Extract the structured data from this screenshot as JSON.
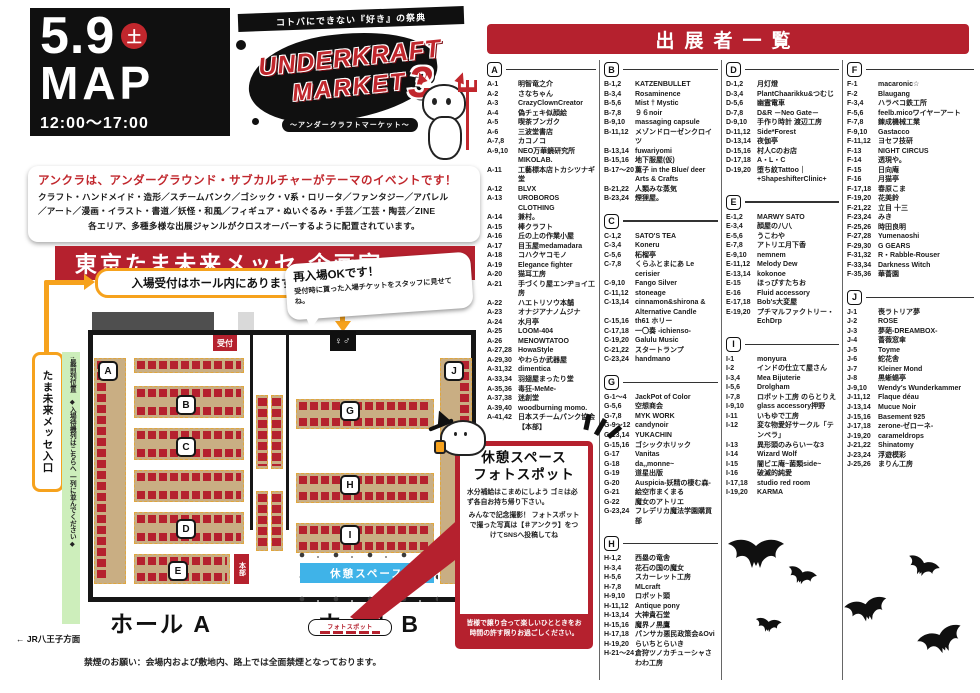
{
  "event": {
    "date_big": "5.9",
    "day_badge": "土",
    "map_label": "MAP",
    "time": "12:00〜17:00",
    "ribbon": "コトバにできない『好き』の祭典",
    "logo_line1": "UNDERKRAFT",
    "logo_line2": "MARKET",
    "logo_number": "3",
    "logo_sub": "〜アンダークラフトマーケット〜"
  },
  "intro": {
    "headline": "アンクラは、アンダーグラウンド・サブカルチャーがテーマのイベントです！",
    "line1": "クラフト・ハンドメイド・造形／スチームパンク／ゴシック・V系・ロリータ／ファンタジー／アパレル",
    "line2": "／アート／漫画・イラスト・書道／妖怪・和風／フィギュア・ぬいぐるみ・手芸／工芸・陶芸／ZINE",
    "line3": "各エリア、多種多様な出展ジャンルがクロスオーバーするように配置されています。"
  },
  "venue_heading": "東京たま未来メッセ 企画室 A・B",
  "map": {
    "reception_callout": "入場受付はホール内にあります",
    "reentry_title": "再入場OKです！",
    "reentry_body": "受付時に貰った入場チケットをスタッフに見せてね。",
    "reception_label": "受付",
    "entrance_label": "出入口",
    "toilet_label": "♀♂",
    "hq_label": "本部",
    "rest_space_label": "休憩スペース",
    "photo_spot_label": "フォトスポット",
    "hall_a_label": "ホール A",
    "hall_b_label": "ホール B",
    "entrance_box": "たま未来メッセ入口",
    "front_row": "↑最前列位置",
    "queue_note": "◆入場待機列はこちらへ 一列に並んでください◆",
    "jr_note": "← JR八王子方面",
    "no_smoking": "禁煙のお願い：会場内および敷地内、路上では全面禁煙となっております。",
    "badges": [
      {
        "letter": "A",
        "x": 98,
        "y": 106
      },
      {
        "letter": "B",
        "x": 176,
        "y": 140
      },
      {
        "letter": "C",
        "x": 176,
        "y": 182
      },
      {
        "letter": "D",
        "x": 176,
        "y": 264
      },
      {
        "letter": "E",
        "x": 168,
        "y": 306
      },
      {
        "letter": "G",
        "x": 340,
        "y": 146
      },
      {
        "letter": "H",
        "x": 340,
        "y": 220
      },
      {
        "letter": "I",
        "x": 340,
        "y": 270
      },
      {
        "letter": "J",
        "x": 444,
        "y": 106
      }
    ]
  },
  "info_box": {
    "title1": "休憩スペース",
    "title2": "フォトスポット",
    "body1": "水分補給はこまめにしよう ゴミは必ず各自お持ち帰り下さい。",
    "body2": "みんなで記念撮影！ フォトスポットで撮った写真は【＃アンクラ】をつけてSNSへ投稿してね",
    "footer": "皆様で譲り合って楽しいひとときをお時間の許す限りお過ごしください。"
  },
  "exhibitors": {
    "title": "出展者一覧",
    "sections": [
      {
        "letter": "A",
        "column": 0,
        "entries": [
          {
            "code": "A-1",
            "name": "明智竜之介"
          },
          {
            "code": "A-2",
            "name": "さなちゃん"
          },
          {
            "code": "A-3",
            "name": "CrazyClownCreator"
          },
          {
            "code": "A-4",
            "name": "偽チェキ似顔絵"
          },
          {
            "code": "A-5",
            "name": "喫茶ブンガク"
          },
          {
            "code": "A-6",
            "name": "三波堂書店"
          },
          {
            "code": "A-7,8",
            "name": "カコノコ"
          },
          {
            "code": "A-9,10",
            "name": "NEO万華鏡研究所MIKOLAB."
          },
          {
            "code": "A-11",
            "name": "工藝標本店トカシツナギ堂"
          },
          {
            "code": "A-12",
            "name": "BLVX"
          },
          {
            "code": "A-13",
            "name": "UROBOROS CLOTHING"
          },
          {
            "code": "A-14",
            "name": "兼村。"
          },
          {
            "code": "A-15",
            "name": "棒クラフト"
          },
          {
            "code": "A-16",
            "name": "丘の上の作業小屋"
          },
          {
            "code": "A-17",
            "name": "目玉屋medamadara"
          },
          {
            "code": "A-18",
            "name": "コハクヤコモノ"
          },
          {
            "code": "A-19",
            "name": "Elegance fighter"
          },
          {
            "code": "A-20",
            "name": "猫耳工房"
          },
          {
            "code": "A-21",
            "name": "手づくり屋エンヂョイ工房"
          },
          {
            "code": "A-22",
            "name": "ハエトリソウ本舗"
          },
          {
            "code": "A-23",
            "name": "オナジアナノムジナ"
          },
          {
            "code": "A-24",
            "name": "水月亭"
          },
          {
            "code": "A-25",
            "name": "LOOM-404"
          },
          {
            "code": "A-26",
            "name": "MENOWTATOO"
          },
          {
            "code": "A-27,28",
            "name": "HowaStyle"
          },
          {
            "code": "A-29,30",
            "name": "やわらか武器屋"
          },
          {
            "code": "A-31,32",
            "name": "dimentica"
          },
          {
            "code": "A-33,34",
            "name": "羽翅屋まったり堂"
          },
          {
            "code": "A-35,36",
            "name": "毒狂-MeMe-"
          },
          {
            "code": "A-37,38",
            "name": "迷創堂"
          },
          {
            "code": "A-39,40",
            "name": "woodburning momo."
          },
          {
            "code": "A-41,42",
            "name": "日本スチームパンク協会【本部】"
          }
        ]
      },
      {
        "letter": "B",
        "column": 1,
        "entries": [
          {
            "code": "B-1,2",
            "name": "KATZENBULLET"
          },
          {
            "code": "B-3,4",
            "name": "Rosaminence"
          },
          {
            "code": "B-5,6",
            "name": "Mist † Mystic"
          },
          {
            "code": "B-7,8",
            "name": "９６noir"
          },
          {
            "code": "B-9,10",
            "name": "massaging capsule"
          },
          {
            "code": "B-11,12",
            "name": "メゾンドローゼンクロイツ"
          },
          {
            "code": "B-13,14",
            "name": "fuwariyomi"
          },
          {
            "code": "B-15,16",
            "name": "地下服屋(仮)"
          },
          {
            "code": "B-17〜20",
            "name": "薫子 in the Blue/ deer Arts & Crafts"
          },
          {
            "code": "B-21,22",
            "name": "人類みな蒸気"
          },
          {
            "code": "B-23,24",
            "name": "煙狸屋。"
          }
        ]
      },
      {
        "letter": "C",
        "column": 1,
        "entries": [
          {
            "code": "C-1,2",
            "name": "SATO'S TEA"
          },
          {
            "code": "C-3,4",
            "name": "Koneru"
          },
          {
            "code": "C-5,6",
            "name": "柘榴亭"
          },
          {
            "code": "C-7,8",
            "name": "くらふとまにあ Le cerisier"
          },
          {
            "code": "C-9,10",
            "name": "Fango Silver"
          },
          {
            "code": "C-11,12",
            "name": "stoneage"
          },
          {
            "code": "C-13,14",
            "name": "cinnamon&shirona & Alternative Candle"
          },
          {
            "code": "C-15,16",
            "name": "th61 ホリー"
          },
          {
            "code": "C-17,18",
            "name": "一〇奏 -ichienso-"
          },
          {
            "code": "C-19,20",
            "name": "Galulu Music"
          },
          {
            "code": "C-21,22",
            "name": "スタートランプ"
          },
          {
            "code": "C-23,24",
            "name": "handmano"
          }
        ]
      },
      {
        "letter": "G",
        "column": 1,
        "entries": [
          {
            "code": "G-1〜4",
            "name": "JackPot of Color"
          },
          {
            "code": "G-5,6",
            "name": "空想商会"
          },
          {
            "code": "G-7,8",
            "name": "MYK WORK"
          },
          {
            "code": "G-9〜12",
            "name": "candynoir"
          },
          {
            "code": "G-13,14",
            "name": "YUKACHIN"
          },
          {
            "code": "G-15,16",
            "name": "ゴシックホリック"
          },
          {
            "code": "G-17",
            "name": "Vanitas"
          },
          {
            "code": "G-18",
            "name": "da,,monne~"
          },
          {
            "code": "G-19",
            "name": "道星出版"
          },
          {
            "code": "G-20",
            "name": "Auspicia-妖精の棲む森-"
          },
          {
            "code": "G-21",
            "name": "絵空市まくまる"
          },
          {
            "code": "G-22",
            "name": "魔女のアトリエ"
          },
          {
            "code": "G-23,24",
            "name": "フレデリカ魔法学園購買部"
          }
        ]
      },
      {
        "letter": "H",
        "column": 1,
        "entries": [
          {
            "code": "H-1,2",
            "name": "西塁の竜舎"
          },
          {
            "code": "H-3,4",
            "name": "花石の国の魔女"
          },
          {
            "code": "H-5,6",
            "name": "スカーレット工房"
          },
          {
            "code": "H-7,8",
            "name": "MLcraft"
          },
          {
            "code": "H-9,10",
            "name": "ロボット頭"
          },
          {
            "code": "H-11,12",
            "name": "Antique pony"
          },
          {
            "code": "H-13,14",
            "name": "大神貴石堂"
          },
          {
            "code": "H-15,16",
            "name": "魔界ノ黒鷹"
          },
          {
            "code": "H-17,18",
            "name": "パンサカ悪民政策会&Ovi"
          },
          {
            "code": "H-19,20",
            "name": "らいちとらいき"
          },
          {
            "code": "H-21〜24",
            "name": "倉狩ツノカチューシャさわわ工房"
          }
        ]
      },
      {
        "letter": "D",
        "column": 2,
        "entries": [
          {
            "code": "D-1,2",
            "name": "月灯燈"
          },
          {
            "code": "D-3,4",
            "name": "PlantChaarikku&つむじ"
          },
          {
            "code": "D-5,6",
            "name": "幽霊電車"
          },
          {
            "code": "D-7,8",
            "name": "D&R －Neo Gate－"
          },
          {
            "code": "D-9,10",
            "name": "手作り時計 渡辺工房"
          },
          {
            "code": "D-11,12",
            "name": "Side*Forest"
          },
          {
            "code": "D-13,14",
            "name": "夜伽亭"
          },
          {
            "code": "D-15,16",
            "name": "村人Cのお店"
          },
          {
            "code": "D-17,18",
            "name": "A・L・C"
          },
          {
            "code": "D-19,20",
            "name": "堕ち紋Tattoo｜ +ShapeshifterClinic+"
          }
        ]
      },
      {
        "letter": "E",
        "column": 2,
        "entries": [
          {
            "code": "E-1,2",
            "name": "MARWY SATO"
          },
          {
            "code": "E-3,4",
            "name": "顔屋の八八"
          },
          {
            "code": "E-5,6",
            "name": "うこわや"
          },
          {
            "code": "E-7,8",
            "name": "アトリエ月下香"
          },
          {
            "code": "E-9,10",
            "name": "nemnem"
          },
          {
            "code": "E-11,12",
            "name": "Melody Dew"
          },
          {
            "code": "E-13,14",
            "name": "kokonoe"
          },
          {
            "code": "E-15",
            "name": "ほっぴすたちお"
          },
          {
            "code": "E-16",
            "name": "Fluid accessory"
          },
          {
            "code": "E-17,18",
            "name": "Bob's大変屋"
          },
          {
            "code": "E-19,20",
            "name": "プチマルファクトリー・EchDrp"
          }
        ]
      },
      {
        "letter": "I",
        "column": 2,
        "entries": [
          {
            "code": "I-1",
            "name": "monyura"
          },
          {
            "code": "I-2",
            "name": "インドの仕立て屋さん"
          },
          {
            "code": "I-3,4",
            "name": "Mea Bijuterie"
          },
          {
            "code": "I-5,6",
            "name": "Drolgham"
          },
          {
            "code": "I-7,8",
            "name": "ロボット工房 のらとりえ"
          },
          {
            "code": "I-9,10",
            "name": "glass accessory押野"
          },
          {
            "code": "I-11",
            "name": "いもゆで工房"
          },
          {
            "code": "I-12",
            "name": "変な物愛好サークル「テンペラ」"
          },
          {
            "code": "I-13",
            "name": "異形頭のみらいーな3"
          },
          {
            "code": "I-14",
            "name": "Wizard Wolf"
          },
          {
            "code": "I-15",
            "name": "闇ビエ庵~菌類side~"
          },
          {
            "code": "I-16",
            "name": "破滅的純愛"
          },
          {
            "code": "I-17,18",
            "name": "studio red room"
          },
          {
            "code": "I-19,20",
            "name": "KARMA"
          }
        ]
      },
      {
        "letter": "F",
        "column": 3,
        "entries": [
          {
            "code": "F-1",
            "name": "macaronic☆"
          },
          {
            "code": "F-2",
            "name": "Blaugang"
          },
          {
            "code": "F-3,4",
            "name": "ハラペコ鉄工所"
          },
          {
            "code": "F-5,6",
            "name": "feelb.micoワイヤーアート"
          },
          {
            "code": "F-7,8",
            "name": "錬成機械工業"
          },
          {
            "code": "F-9,10",
            "name": "Gastacco"
          },
          {
            "code": "F-11,12",
            "name": "ヨセフ技研"
          },
          {
            "code": "F-13",
            "name": "NIGHT CIRCUS"
          },
          {
            "code": "F-14",
            "name": "透現や。"
          },
          {
            "code": "F-15",
            "name": "日向庵"
          },
          {
            "code": "F-16",
            "name": "月猫亭"
          },
          {
            "code": "F-17,18",
            "name": "春原こま"
          },
          {
            "code": "F-19,20",
            "name": "花美鈴"
          },
          {
            "code": "F-21,22",
            "name": "立目 十三"
          },
          {
            "code": "F-23,24",
            "name": "みき"
          },
          {
            "code": "F-25,26",
            "name": "時田良明"
          },
          {
            "code": "F-27,28",
            "name": "Yumenaoshi"
          },
          {
            "code": "F-29,30",
            "name": "G GEARS"
          },
          {
            "code": "F-31,32",
            "name": "R・Rabble-Rouser"
          },
          {
            "code": "F-33,34",
            "name": "Darkness Witch"
          },
          {
            "code": "F-35,36",
            "name": "華薔園"
          }
        ]
      },
      {
        "letter": "J",
        "column": 3,
        "entries": [
          {
            "code": "J-1",
            "name": "喪ラトリア夢"
          },
          {
            "code": "J-2",
            "name": "ROSE"
          },
          {
            "code": "J-3",
            "name": "夢葩-DREAMBOX-"
          },
          {
            "code": "J-4",
            "name": "薔薇窓傘"
          },
          {
            "code": "J-5",
            "name": "Toyme"
          },
          {
            "code": "J-6",
            "name": "蛇花舎"
          },
          {
            "code": "J-7",
            "name": "Kleiner Mond"
          },
          {
            "code": "J-8",
            "name": "黒蜥蜴亭"
          },
          {
            "code": "J-9,10",
            "name": "Wendy's Wunderkammer"
          },
          {
            "code": "J-11,12",
            "name": "Flaque déau"
          },
          {
            "code": "J-13,14",
            "name": "Mucue Noir"
          },
          {
            "code": "J-15,16",
            "name": "Basement 925"
          },
          {
            "code": "J-17,18",
            "name": "zerone-ゼローネ-"
          },
          {
            "code": "J-19,20",
            "name": "carameldrops"
          },
          {
            "code": "J-21,22",
            "name": "Shinatomy"
          },
          {
            "code": "J-23,24",
            "name": "浮遊模彩"
          },
          {
            "code": "J-25,26",
            "name": "まりん工房"
          }
        ]
      }
    ]
  },
  "colors": {
    "accent_red": "#b5212e",
    "black": "#101010",
    "booth_tan": "#c9ae83",
    "rest_blue": "#3fb3e8",
    "queue_green": "#cdeebb",
    "arrow_orange": "#f6a21d"
  }
}
